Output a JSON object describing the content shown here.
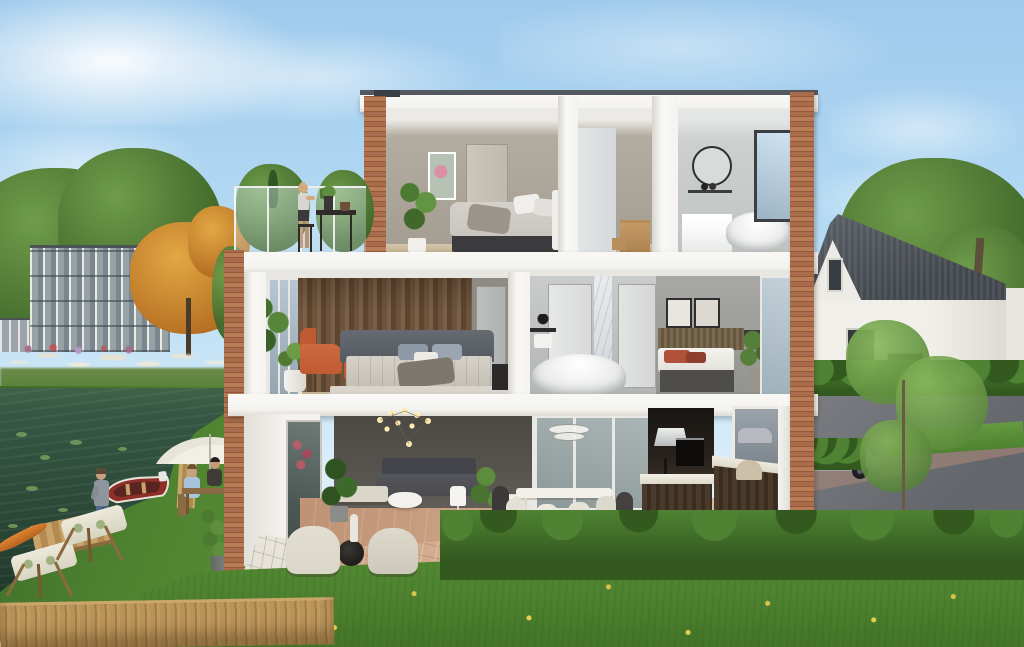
{
  "scene": {
    "type": "architectural cutaway render",
    "description": "Cross-section 3D visualisation of a modern three-storey canal-side townhouse with furnished interiors, roof terrace, garden, canal and neighbouring houses",
    "environment": {
      "sky": "clear blue with wispy clouds",
      "left": [
        "green trees",
        "grey apartment block",
        "orange autumn tree",
        "white pampas grass bank",
        "dark canal water with lily pads",
        "wooden dock",
        "orange kayak",
        "red rowing boat"
      ],
      "right": [
        "white gabled neighbour house with dark roof",
        "large green tree",
        "young sapling",
        "paved street with parked grey car",
        "clipped hedges"
      ],
      "foreground": [
        "green lawn with yellow wildflowers",
        "scalloped garden hedge",
        "terracotta patio",
        "light paver path",
        "wooden plank fence"
      ]
    },
    "people": [
      {
        "name": "woman-on-terrace",
        "pose": "standing at bar table on roof terrace"
      },
      {
        "name": "man-at-water",
        "pose": "standing at the canal edge"
      },
      {
        "name": "group-at-garden-table",
        "pose": "three people seated under a white parasol"
      }
    ],
    "house": {
      "floors": [
        {
          "name": "top-floor",
          "rooms": [
            "bedroom with double bed, wall art, potted plant",
            "hallway with cardboard moving boxes",
            "bathroom with round mirror, vanity and freestanding tub"
          ],
          "outdoor": "roof terrace with glass railing, bar table and plants"
        },
        {
          "name": "middle-floor",
          "rooms": [
            "master bedroom with dark wood feature wall, grey upholstered bed and orange armchair",
            "bathroom with freestanding tub, marble column and black shower fixture",
            "single bedroom with slatted headboard, rust pillows and two framed prints"
          ]
        },
        {
          "name": "ground-floor",
          "rooms": [
            "living room with arc floor lamp, grey sofa, coffee table and daybed",
            "dining area with white table, cream and black chairs and glass-disc pendant",
            "kitchen with dark wood island, tall cabinets, oven and range hood"
          ]
        }
      ],
      "structure": [
        "white concrete floor slabs",
        "red-brick corner pillars",
        "glass balustrade on terrace"
      ]
    }
  },
  "palette": {
    "sky-top": "#9ecaec",
    "sky-low": "#ddeefa",
    "cloud": "#ffffff",
    "water-a": "#355743",
    "water-b": "#1e342a",
    "grass-a": "#4e8230",
    "grass-b": "#659b40",
    "hedge-a": "#33591f",
    "hedge-b": "#4f8232",
    "white-a": "#f4f3f0",
    "white-b": "#f9f8f5",
    "white-c": "#e3e1da",
    "brick-a": "#a86c4c",
    "brick-b": "#96573b",
    "brick-c": "#b77d57",
    "beige": "#b3aca0",
    "greywall": "#57534e",
    "bathgrey": "#cdd0cf",
    "wood-a": "#6e543c",
    "wood-b": "#7d6147",
    "wood-c": "#5c4631",
    "terra-a": "#bf9274",
    "terra-b": "#d0ab8b",
    "kdark": "#27211c",
    "glass-a": "#cfe0ea",
    "glass-b": "#93a7b4",
    "roof-n": "#42474d",
    "street-a": "#7b7d82",
    "street-b": "#63666b",
    "band": "#9c8176",
    "autumn-a": "#b66f22",
    "autumn-b": "#e2a844",
    "tree-a": "#3f6628",
    "tree-b": "#6f9c4b",
    "orange": "#c05a33",
    "fence-a": "#b8935a",
    "fence-b": "#a27c47",
    "umb": "#f2efe7",
    "boat": "#8e2f2a",
    "kayak": "#d9782e",
    "sofa": "#4a4b4f",
    "duvet": "#c9c6c0",
    "pillow": "#8d99a5",
    "cream": "#dad6c8"
  }
}
